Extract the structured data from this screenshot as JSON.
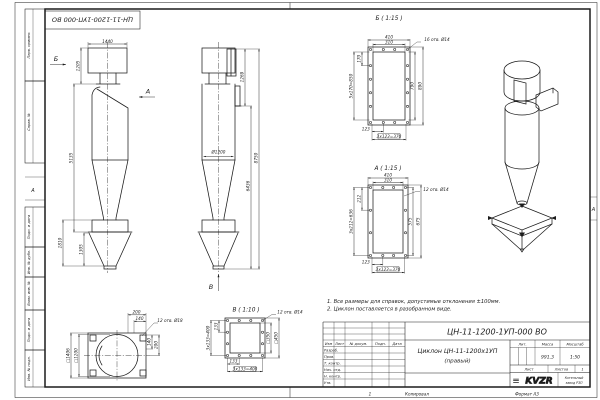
{
  "sheet": {
    "stamp_top_left": "ЦН-11-1200-1УП-000 ВО",
    "zone_left": "А",
    "zone_right": "А",
    "zone_bottom": "1",
    "copy_label": "Копировал",
    "format_label": "Формат А3",
    "colors": {
      "ink": "#1c1c1c",
      "paper": "#ffffff"
    }
  },
  "margin_fields": {
    "perv_primen": "Перв. примен.",
    "sprav_no": "Справ. №",
    "podp_data_1": "Подп. и дата",
    "inv_dubl": "Инв. № дубл.",
    "vzam_inv": "Взам. инв. №",
    "podp_data_2": "Подп. и дата",
    "inv_podl": "Инв. № подл."
  },
  "notes": {
    "line1": "1. Все размеры для справок, допустимые отклонения ±100мм.",
    "line2": "2. Циклон поставляется в разобранном виде."
  },
  "front_view": {
    "arrow_b": "Б",
    "arrow_a": "А",
    "dim_width_top": "1440",
    "dim_inlet_height": "1205",
    "dim_body_height": "5135",
    "dim_bunker_height": "1810",
    "dim_cone_height": "1305"
  },
  "side_view": {
    "arrow_v": "В",
    "dim_diameter": "Ø1200",
    "dim_flange_height": "1269",
    "dim_lower_height": "6436",
    "dim_total_height": "8750"
  },
  "section_b": {
    "title": "Б ( 1:15 )",
    "holes_note": "16 отв. Ø14",
    "dim_outer_width": "410",
    "dim_inner_width": "310",
    "dim_pitch_v": "170",
    "dim_pitch_v_total": "5х170=850",
    "dim_inner_height": "790",
    "dim_outer_height": "890",
    "dim_pitch_h": "123",
    "dim_pitch_h_total": "3х123=370"
  },
  "section_a": {
    "title": "А ( 1:15 )",
    "holes_note": "12 отв. Ø14",
    "dim_outer_width": "410",
    "dim_inner_width": "310",
    "dim_pitch_v": "212",
    "dim_pitch_v_total": "3х212=636",
    "dim_inner_height": "575",
    "dim_outer_height": "675",
    "dim_pitch_h": "123",
    "dim_pitch_h_total": "3х123=370"
  },
  "view_v": {
    "title": "В ( 1:10 )",
    "holes_note": "12 отв. Ø14",
    "dim_pitch_left": "133",
    "dim_pitch_left_total": "3х133=400",
    "dim_inner": "□350",
    "dim_outer": "□450",
    "dim_pitch_bottom": "133",
    "dim_pitch_bottom_total": "3х133=400"
  },
  "plan_view": {
    "holes_note": "12 отв. Ø18",
    "dim_pad_offset_1": "200",
    "dim_pad_offset_2": "140",
    "dim_right_1": "140",
    "dim_right_2": "200",
    "dim_square_outer": "□1406",
    "dim_square_inner": "□1200"
  },
  "title_block": {
    "doc_number": "ЦН-11-1200-1УП-000 ВО",
    "name_line1": "Циклон ЦН-11-1200х1УП",
    "name_line2": "(правый)",
    "header_izm": "Изм",
    "header_list": "Лист",
    "header_dokum": "№ докум.",
    "header_podp": "Подп.",
    "header_data": "Дата",
    "row_razrab": "Разраб.",
    "row_prov": "Пров.",
    "row_tkontr": "Т. контр.",
    "row_nachotd": "Нач. отд.",
    "row_nkontr": "Н. контр.",
    "row_utv": "Утв.",
    "lit_label": "Лит.",
    "mass_label": "Масса",
    "scale_label": "Масштаб",
    "mass_value": "991,3",
    "scale_value": "1:50",
    "sheet_label": "Лист",
    "sheets_label": "Листов",
    "sheets_value": "1",
    "logo_mark": "≡",
    "logo_text": "KVZR",
    "company_line1": "Котельный",
    "company_line2": "завод РЗП"
  }
}
